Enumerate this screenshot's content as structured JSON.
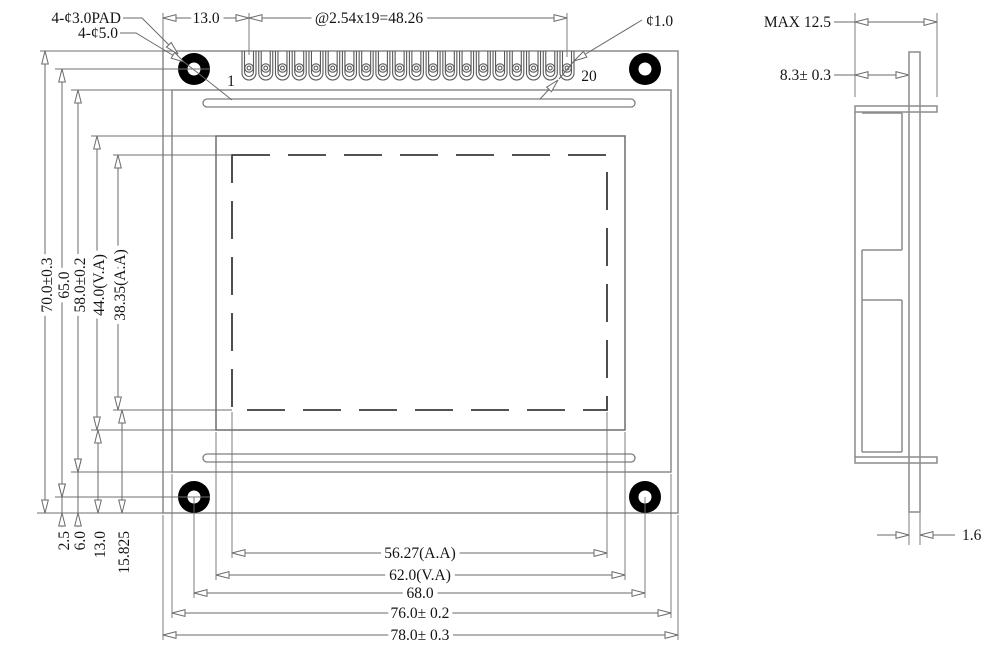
{
  "front_view": {
    "pin_count": 20,
    "callouts": {
      "pad_hole": "4-¢3.0PAD",
      "mounting_hole": "4-¢5.0",
      "pin_hole": "¢1.0",
      "pin_first": "1",
      "pin_last": "20"
    },
    "top_dims": {
      "pin1_offset": "13.0",
      "pin_pitch": "@2.54x19=48.26"
    },
    "left_dims": {
      "board_height": "70.0±0.3",
      "hole_spacing": "65.0",
      "frame_height": "58.0±0.2",
      "viewing_area_height": "44.0(V.A)",
      "active_area_height": "38.35(A.A)"
    },
    "bottom_left_dims": {
      "hole_to_edge": "2.5",
      "frame_to_edge": "6.0",
      "viewing_to_edge": "13.0",
      "active_to_edge": "15.825"
    },
    "bottom_dims": {
      "active_area_width": "56.27(A.A)",
      "viewing_area_width": "62.0(V.A)",
      "hole_spacing": "68.0",
      "frame_width": "76.0± 0.2",
      "board_width": "78.0± 0.3"
    }
  },
  "side_view": {
    "dims": {
      "max_depth": "MAX 12.5",
      "front_to_pcb": "8.3± 0.3",
      "pcb_thickness": "1.6"
    }
  }
}
